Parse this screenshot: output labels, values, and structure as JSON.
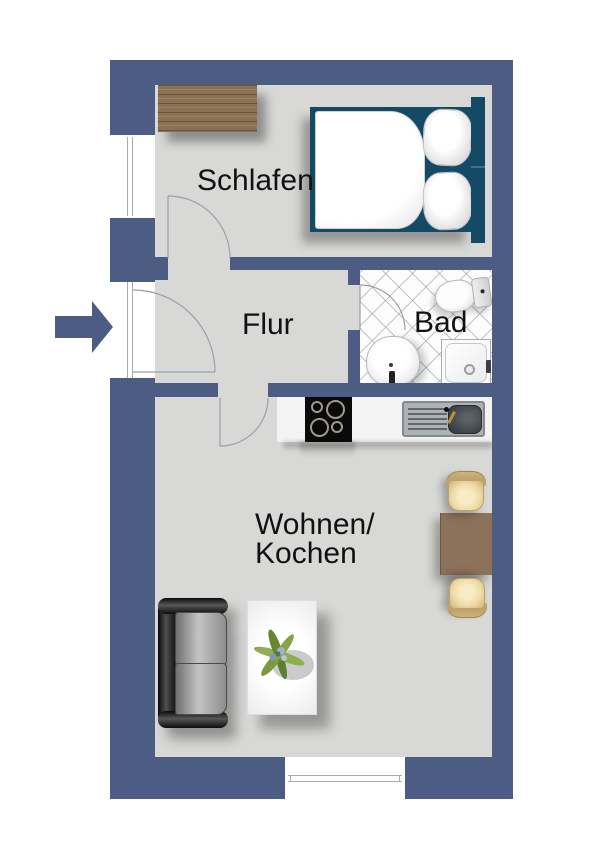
{
  "plan": {
    "type": "apartment-floor-plan",
    "orientation": "top-view"
  },
  "rooms": {
    "schlafen": {
      "label": "Schlafen"
    },
    "flur": {
      "label": "Flur"
    },
    "bad": {
      "label": "Bad"
    },
    "wohnen_kochen": {
      "line1": "Wohnen/",
      "line2": "Kochen"
    }
  },
  "entry": {
    "symbol": "entry-arrow",
    "direction": "right"
  },
  "furniture": [
    "wardrobe",
    "double-bed",
    "toilet",
    "washbasin",
    "shower-tray",
    "cooktop",
    "kitchen-sink",
    "kitchen-counter",
    "dining-table",
    "dining-chair",
    "dining-chair",
    "sofa",
    "coffee-table",
    "potted-plant"
  ],
  "colors": {
    "wall": "#4d5c82",
    "floor": "#d8d8d6",
    "bad_tile_line": "#969eac",
    "bed_frame": "#154a66",
    "wardrobe": "#8a7154",
    "dining_table": "#8b7259",
    "chair_seat": "#eedaa4",
    "counter": "#f3f3f3",
    "arrow": "#4d5c82",
    "text": "#111111"
  }
}
